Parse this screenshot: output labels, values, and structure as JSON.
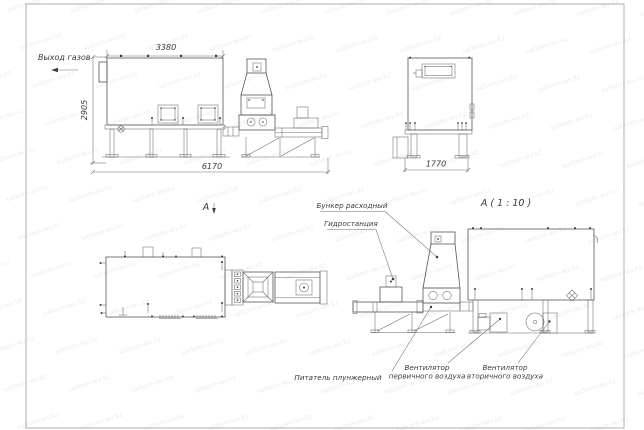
{
  "watermark": {
    "text": "satkom-wv.kz"
  },
  "side_view": {
    "dim_top": "3380",
    "dim_left": "2905",
    "dim_bottom": "6170",
    "gas_outlet_label": "Выход газов"
  },
  "end_view": {
    "dim_bottom": "1770"
  },
  "plan_view": {
    "view_label": "А"
  },
  "detail_view": {
    "title": "А ( 1 : 10 )",
    "callout_hopper": "Бункер расходный",
    "callout_hydraulic": "Гидростанция",
    "callout_feeder": "Питатель плунжерный",
    "callout_fan_primary_1": "Вентилятор",
    "callout_fan_primary_2": "первичного воздуха",
    "callout_fan_secondary_1": "Вентилятор",
    "callout_fan_secondary_2": "вторичного воздуха"
  },
  "colors": {
    "line": "#565656",
    "dim_text": "#3a3a3a",
    "frame": "#aab0b6",
    "watermark": "#e9ebee",
    "background": "#ffffff"
  }
}
